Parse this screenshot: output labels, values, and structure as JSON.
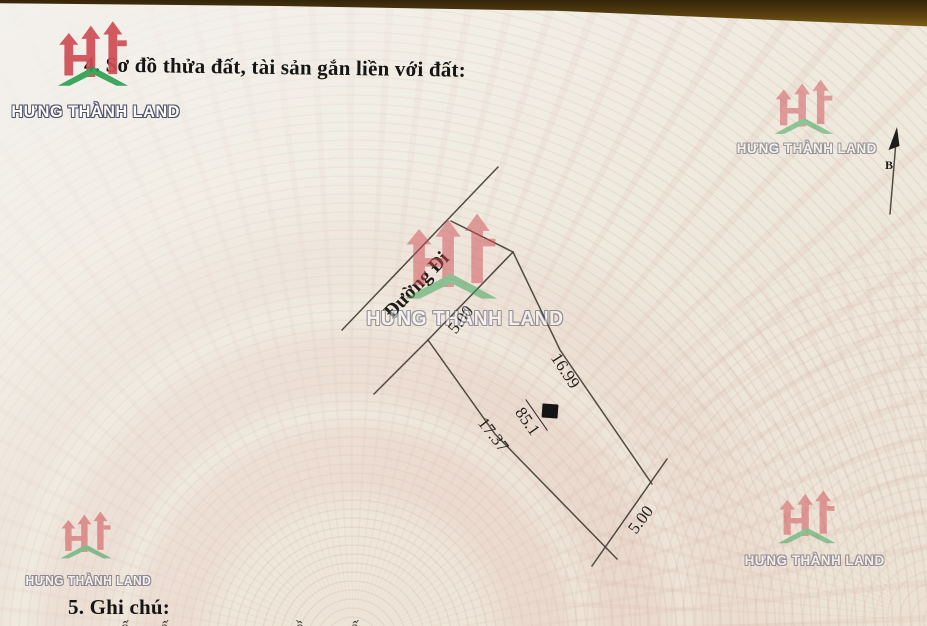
{
  "document": {
    "section4_heading": "4. Sơ đồ thửa đất, tài sản gắn liền với đất:",
    "section5_heading": "5. Ghi chú:",
    "bottom_clipped_text": "…ố……ấ……………………ề………ấ……"
  },
  "watermark": {
    "brand": "HƯNG THÀNH LAND",
    "red": "#cf4e56",
    "green": "#2fa052"
  },
  "diagram": {
    "road_label": "Đường Đi",
    "north_label": "B",
    "area_label": "85.1",
    "dimensions": {
      "top_edge": "5.00",
      "right_edge": "16.99",
      "left_edge": "17.37",
      "bottom_edge": "5.00"
    }
  },
  "colors": {
    "paper": "#efeade",
    "table_edge": "#5d4410",
    "diagram_line": "#3b352e",
    "redaction_box": "#141414",
    "guilloche_pink": "#e7cdc4"
  }
}
